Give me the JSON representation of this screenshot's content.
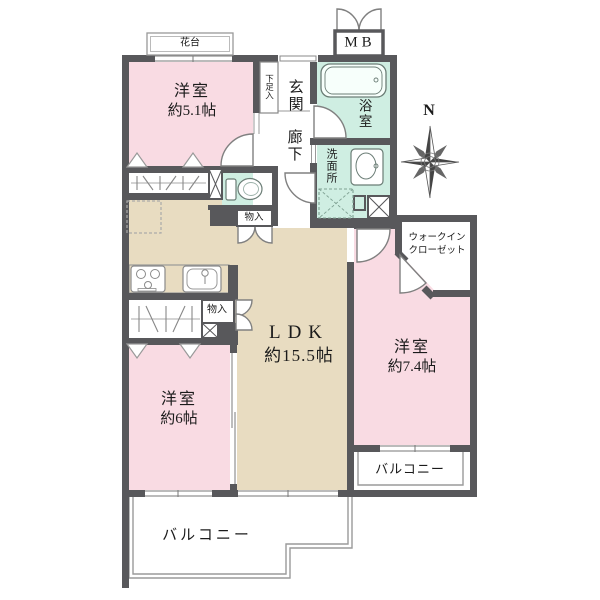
{
  "meta": {
    "type": "floor-plan"
  },
  "colors": {
    "room_pink": "#f9dbe3",
    "ldk_beige": "#e8dcc1",
    "wet_mint": "#cfeee2",
    "wall_gray": "#58585b",
    "thin_line": "#999999",
    "text": "#1b1b1b"
  },
  "rooms": {
    "bedroom_a": {
      "name": "洋室",
      "size": "約5.1帖"
    },
    "bedroom_b": {
      "name": "洋室",
      "size": "約6帖"
    },
    "bedroom_c": {
      "name": "洋室",
      "size": "約7.4帖"
    },
    "ldk": {
      "name": "LDK",
      "size": "約15.5帖"
    },
    "entrance": "玄関",
    "hallway": "廊下",
    "bathroom": "浴室",
    "washroom": "洗面所",
    "wic_line1": "ウォークイン",
    "wic_line2": "クローゼット",
    "meter_box": "MB",
    "flower_stand": "花台",
    "shoe_cabinet": "下足入",
    "storage_hall": "物入",
    "storage_kitchen": "物入",
    "balcony_south": "バルコニー",
    "balcony_east": "バルコニー"
  },
  "compass": {
    "north": "N"
  }
}
